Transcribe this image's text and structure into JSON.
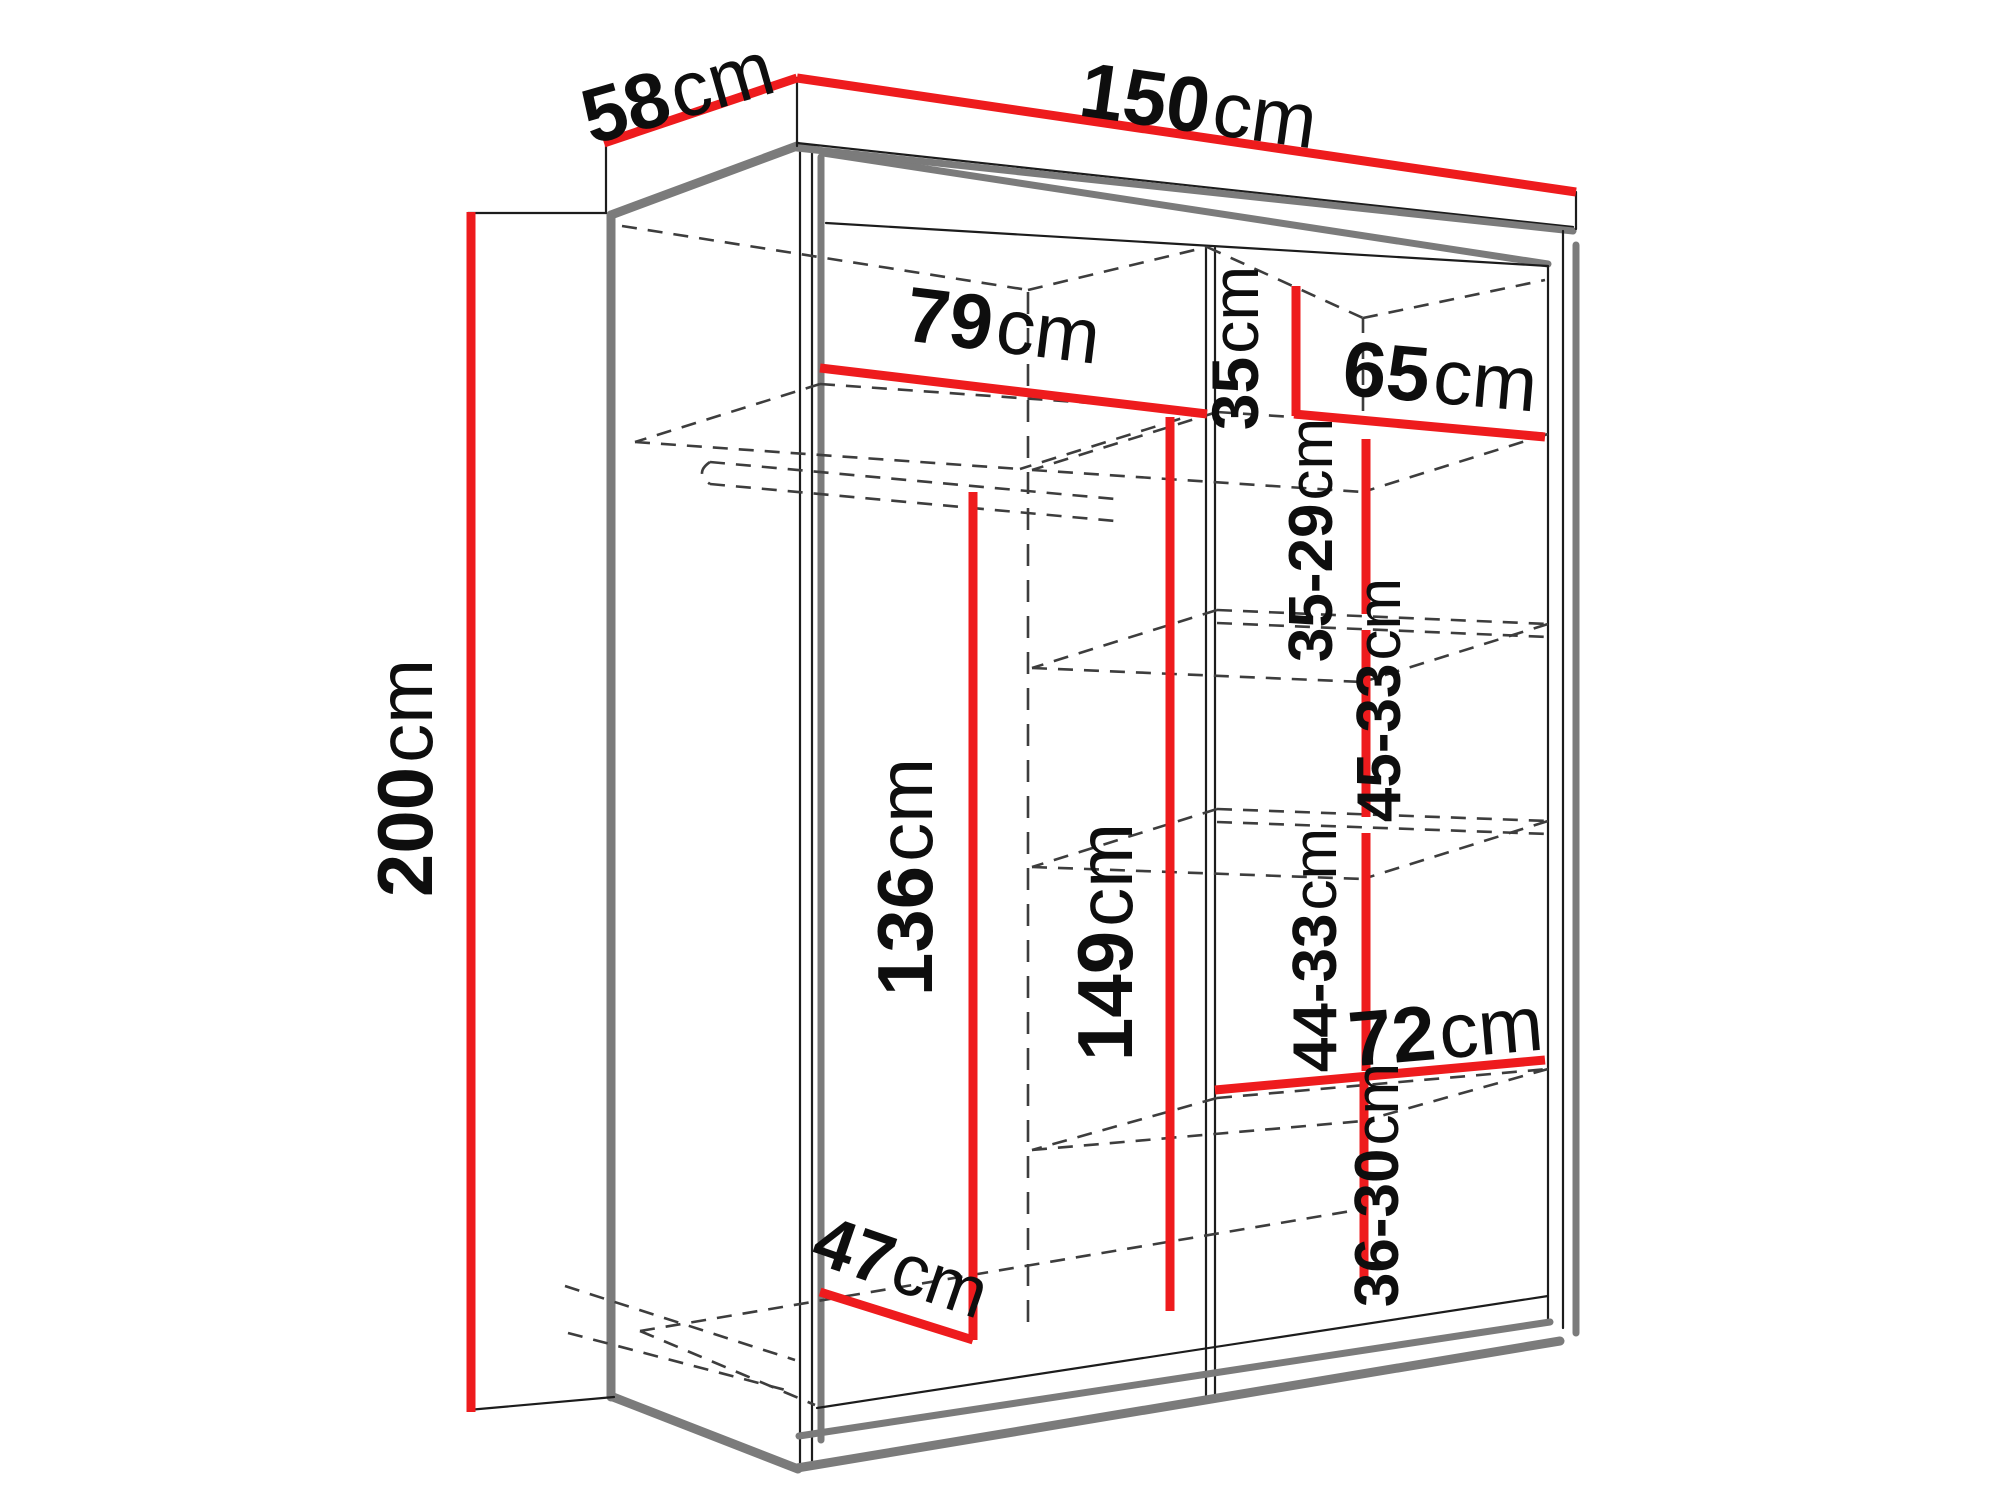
{
  "dimensions": {
    "depth_top": {
      "value": "58",
      "unit": "cm"
    },
    "width_top": {
      "value": "150",
      "unit": "cm"
    },
    "height_left": {
      "value": "200",
      "unit": "cm"
    },
    "left_compartment_width": {
      "value": "79",
      "unit": "cm"
    },
    "top_right_shelf_height": {
      "value": "35",
      "unit": "cm"
    },
    "right_compartment_width": {
      "value": "65",
      "unit": "cm"
    },
    "right_shelf_gap_1": {
      "value": "35-29",
      "unit": "cm"
    },
    "right_shelf_gap_2": {
      "value": "45-33",
      "unit": "cm"
    },
    "right_shelf_gap_3": {
      "value": "44-33",
      "unit": "cm"
    },
    "lower_right_shelf_width": {
      "value": "72",
      "unit": "cm"
    },
    "right_shelf_gap_4": {
      "value": "36-30",
      "unit": "cm"
    },
    "left_interior_height": {
      "value": "136",
      "unit": "cm"
    },
    "middle_interior_height": {
      "value": "149",
      "unit": "cm"
    },
    "bottom_left_depth": {
      "value": "47",
      "unit": "cm"
    }
  },
  "colors": {
    "dimension_line": "#ee1b1d",
    "structure_gray": "#7b7b7b",
    "outline_black": "#1c1c1c",
    "dashed_hidden": "#3d3d3d",
    "label_text": "#0e0e0e",
    "background": "#ffffff"
  }
}
